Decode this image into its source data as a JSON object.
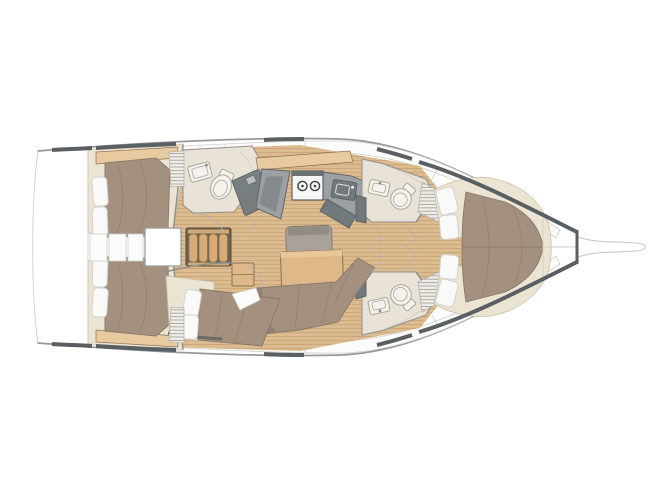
{
  "meta": {
    "description": "Top-down interior layout plan of a sailing yacht, bow pointing right, no visible text labels",
    "canvas": {
      "width": 667,
      "height": 500
    },
    "background": "#ffffff"
  },
  "palette": {
    "hull-line": "#97999a",
    "hull-dark": "#595f62",
    "wall-line": "#8f8f8c",
    "panel": "#fbfbfa",
    "panel-line": "#cfcfca",
    "wood-floor": "#dcbb8e",
    "plank": "#c9a276",
    "wood-furn": "#dfb88a",
    "wood-light": "#e7caa0",
    "wood-edge": "#8d7252",
    "cream": "#ece4d3",
    "cream-edge": "#c9bfa9",
    "mattress": "#a3907f",
    "mattress-dark": "#94816f",
    "mattress-edge": "#897768",
    "pillow": "#f9f9f7",
    "pillow-edge": "#d2d2cc",
    "counter": "#9aa0a3",
    "counter-dark": "#72797c",
    "counter-edge": "#596063",
    "fixture": "#f4f2ec",
    "fixture-edge": "#aba69b",
    "head-floor": "#e9e2d7",
    "bench": "#a8a29b",
    "bench-back": "#918b83",
    "bench-edge": "#7e7870",
    "locker": "#f0ede7"
  },
  "features": {
    "parts": [
      "hull-outline",
      "transom-swim-platform",
      "bowsprit",
      "bow-locker",
      "aft-cabin-starboard",
      "aft-cabin-port",
      "companionway-steps",
      "engine-compartment",
      "aft-head",
      "nav-station-desk",
      "galley",
      "stove-burners",
      "galley-sink",
      "saloon-table",
      "saloon-bench",
      "saloon-settee",
      "mid-cabin",
      "forward-head-starboard",
      "forward-head-port",
      "toilet",
      "washbasin",
      "hanging-locker",
      "forward-cabin-berth",
      "door-swing-arcs",
      "folding-door-zigzags",
      "deck-hatch-segments",
      "side-deck-panels",
      "wood-plank-sole"
    ]
  }
}
